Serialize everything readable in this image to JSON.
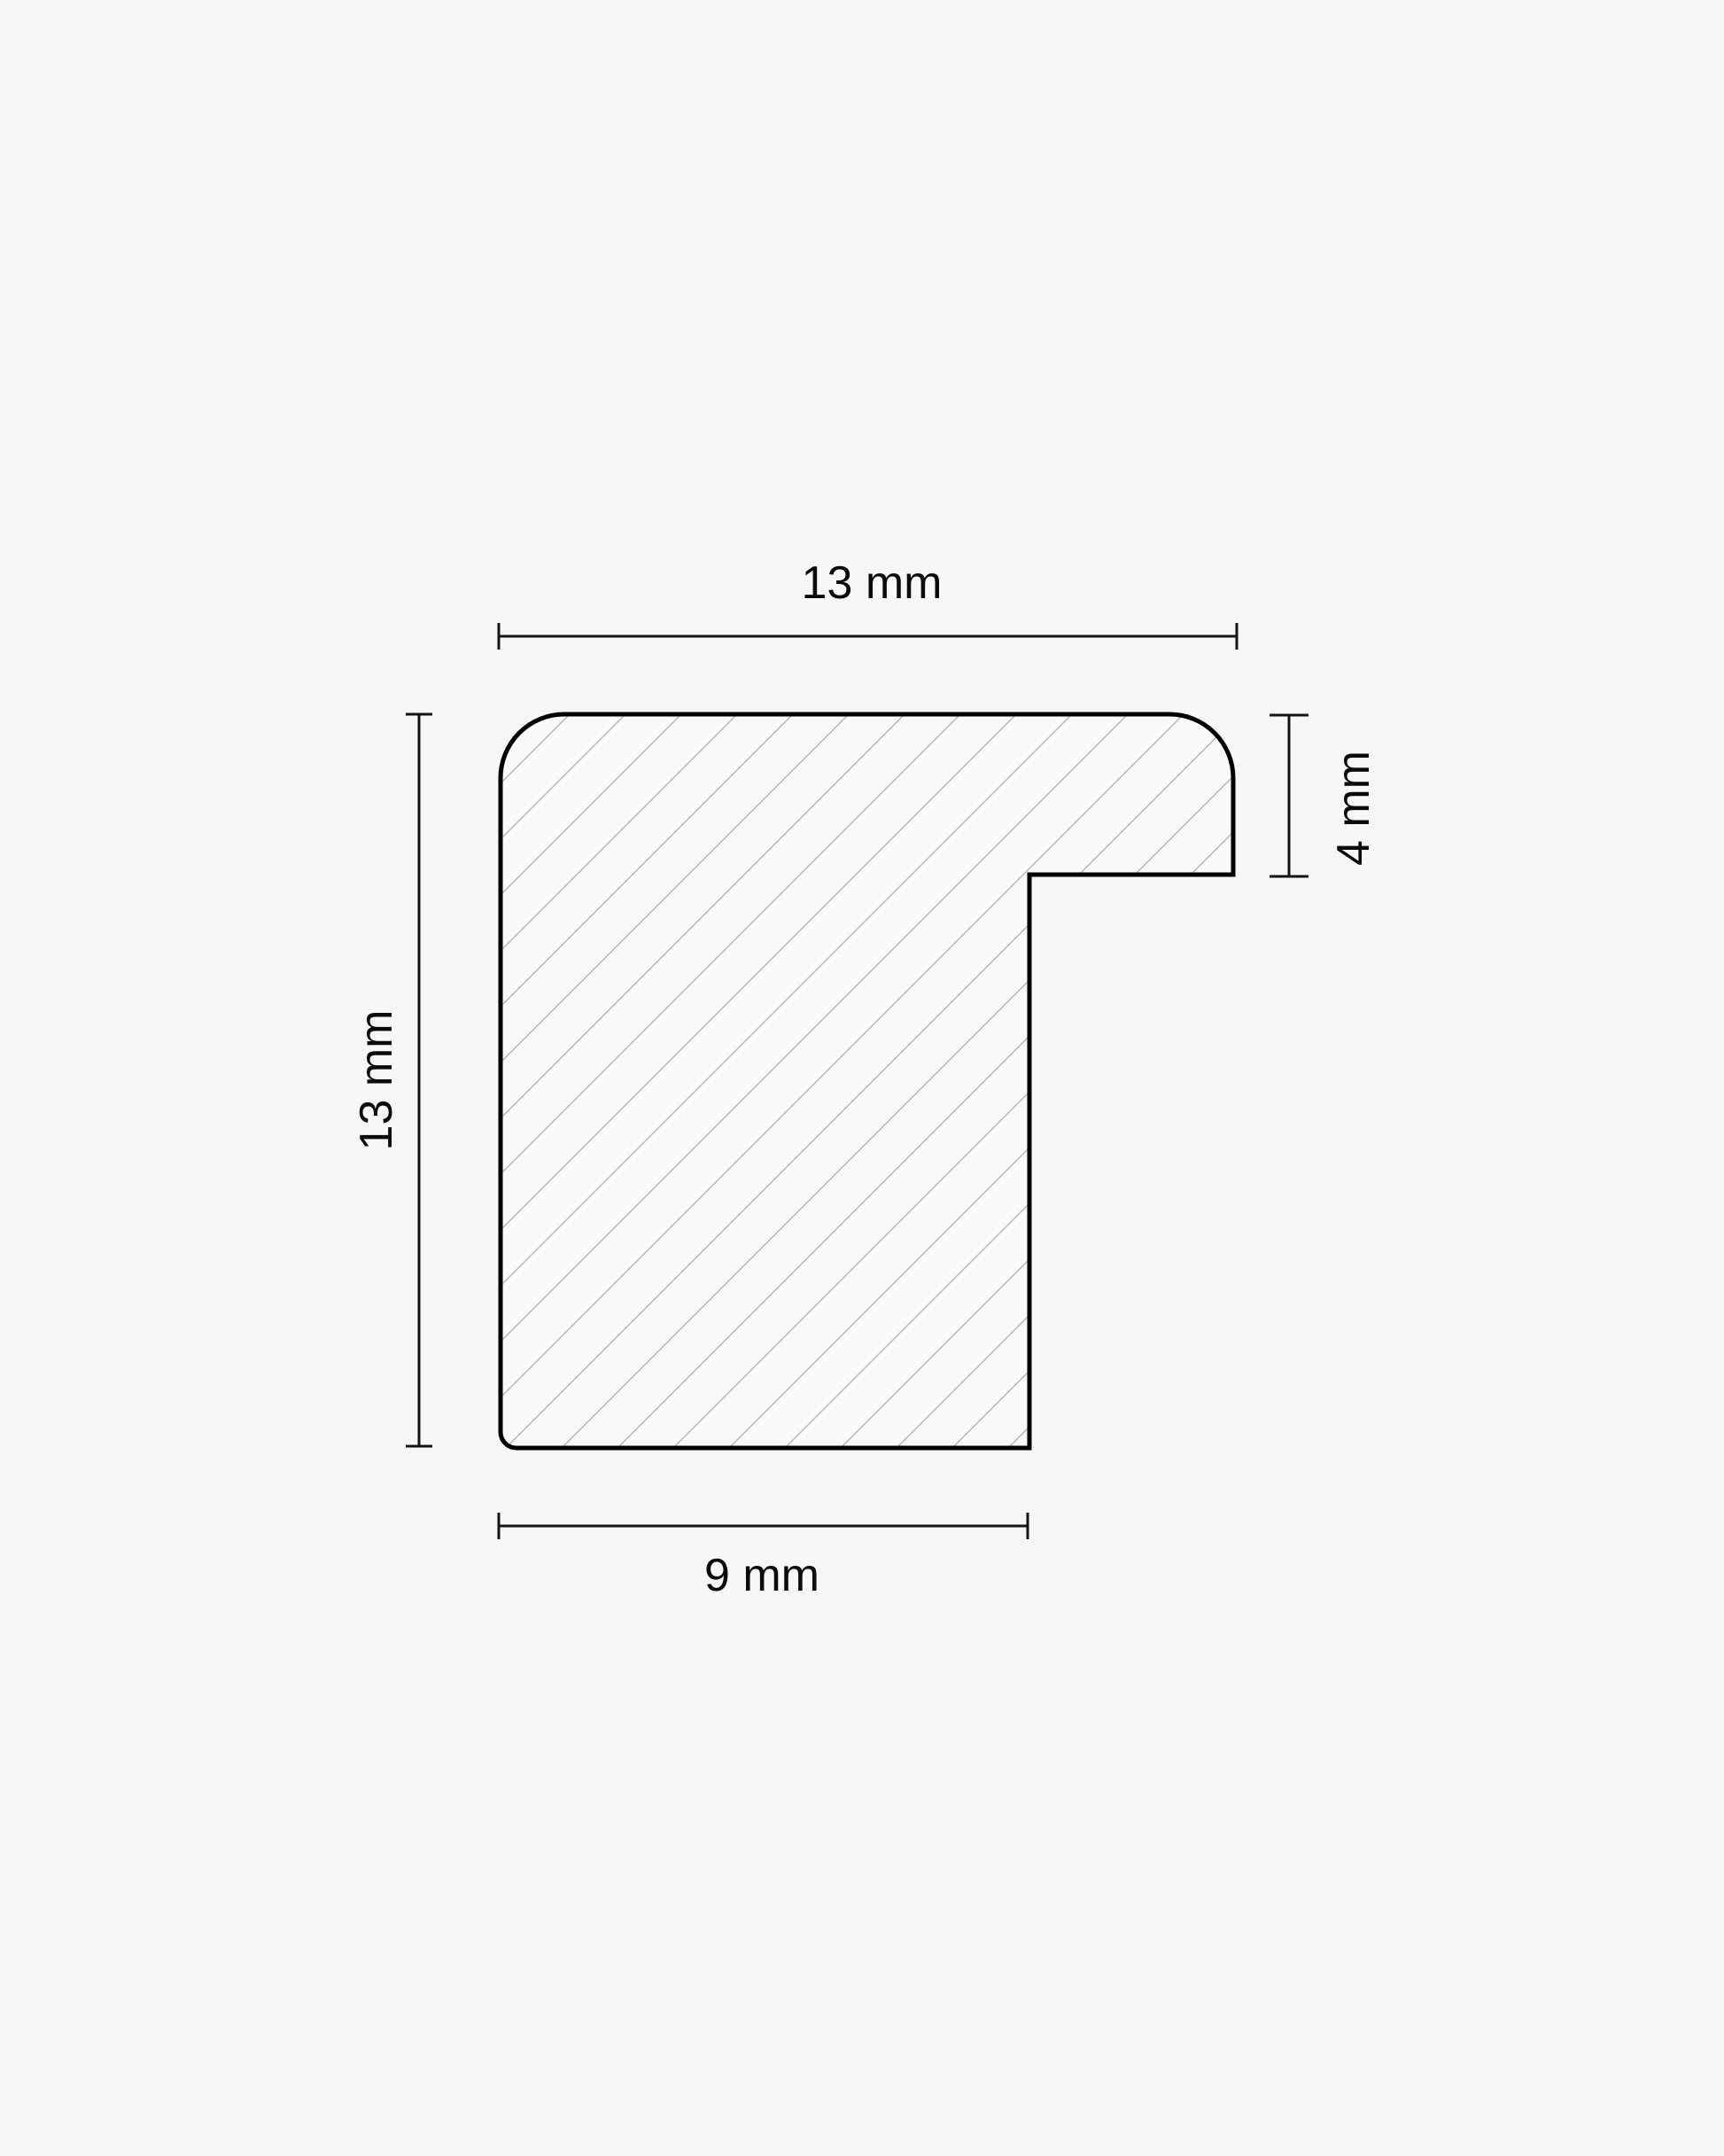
{
  "diagram": {
    "unit": "mm",
    "dimensions": {
      "top_width": {
        "value": 13,
        "label": "13 mm"
      },
      "left_height": {
        "value": 13,
        "label": "13 mm"
      },
      "right_depth": {
        "value": 4,
        "label": "4 mm"
      },
      "bottom_width": {
        "value": 9,
        "label": "9 mm"
      }
    },
    "colors": {
      "background": "#f7f7f9",
      "profile_fill": "#fafafb",
      "hatch_line": "#b3b3b8",
      "outline": "#000000",
      "dimension_line": "#141414",
      "label_text": "#0b0b0c"
    }
  }
}
